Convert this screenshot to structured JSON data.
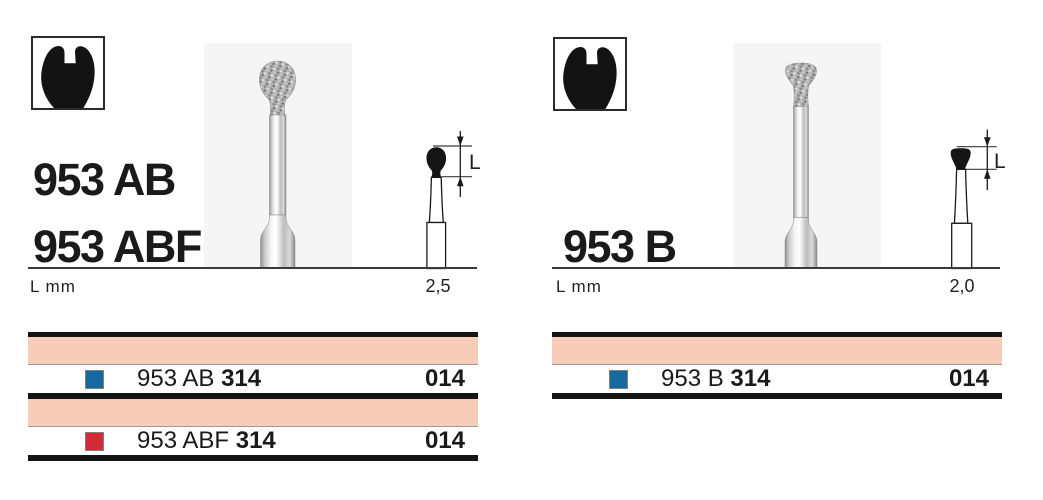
{
  "colors": {
    "accent_band": "#f7cdb9",
    "blue": "#1668a0",
    "red": "#d32b35",
    "rule": "#151515"
  },
  "icons": {
    "family": "tooth-crown-icon"
  },
  "panels": {
    "left": {
      "titles": [
        "953 AB",
        "953 ABF"
      ],
      "scale_label": "L mm",
      "size_value": "2,5",
      "diagram_label": "L",
      "table": {
        "rows": [
          {
            "color_name": "blue",
            "color": "#1668a0",
            "code": "953 AB",
            "iso": "314",
            "size": "014"
          },
          {
            "color_name": "red",
            "color": "#d32b35",
            "code": "953 ABF",
            "iso": "314",
            "size": "014"
          }
        ]
      }
    },
    "right": {
      "title": "953 B",
      "scale_label": "L mm",
      "size_value": "2,0",
      "diagram_label": "L",
      "table": {
        "rows": [
          {
            "color_name": "blue",
            "color": "#1668a0",
            "code": "953 B",
            "iso": "314",
            "size": "014"
          }
        ]
      }
    }
  }
}
